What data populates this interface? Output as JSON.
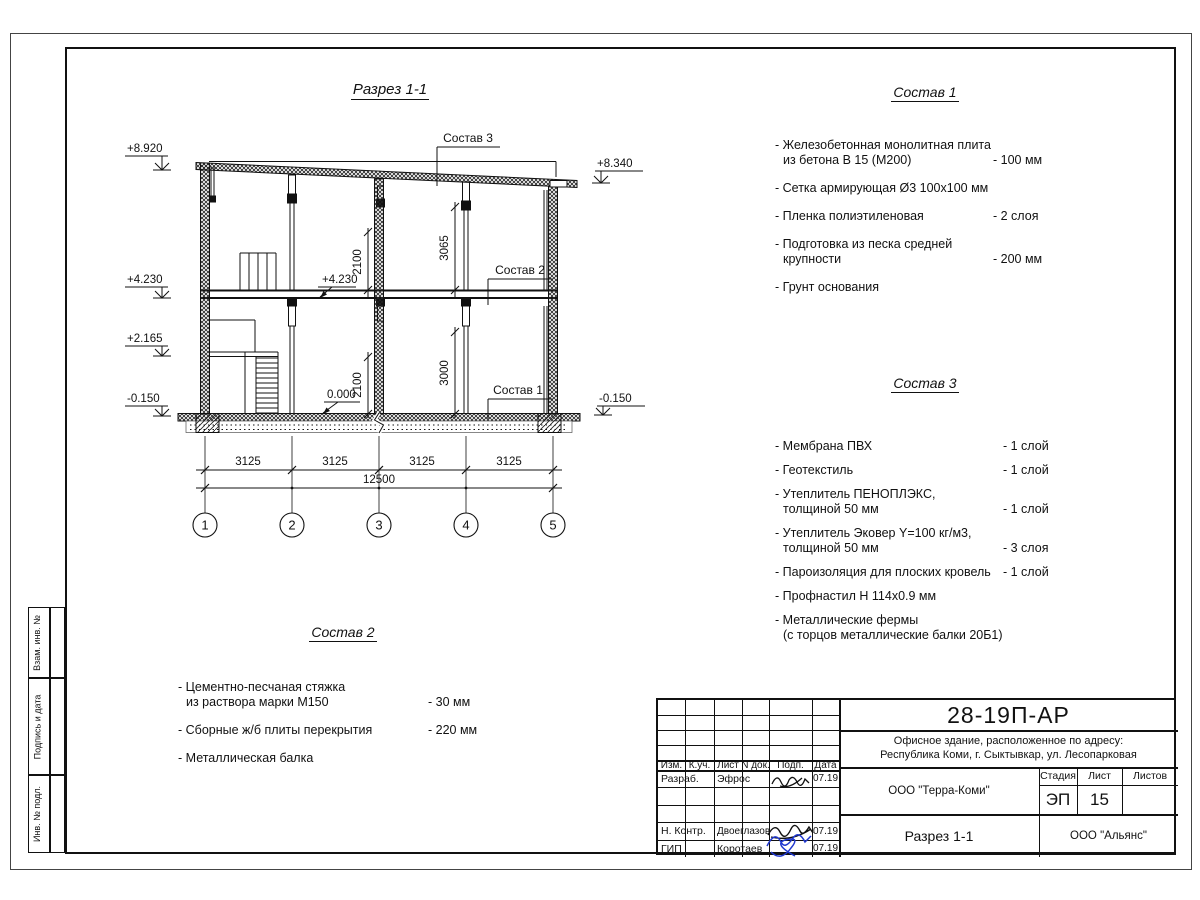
{
  "colors": {
    "line": "#111111",
    "signature_ink_blue": "#2038cf"
  },
  "drawing": {
    "title": "Разрез 1-1",
    "callouts": {
      "sostav1": "Состав 1",
      "sostav2": "Состав 2",
      "sostav3": "Состав 3"
    },
    "elevations": {
      "left_top": "+8.920",
      "left_mid": "+4.230",
      "left_low": "+2.165",
      "left_base": "-0.150",
      "right_top": "+8.340",
      "right_base": "-0.150",
      "inner_floor2": "+4.230",
      "inner_floor1": "0.000"
    },
    "vdims": {
      "floor2_opening": "2100",
      "floor2_clear": "3065",
      "floor1_opening": "2100",
      "floor1_clear": "3000"
    },
    "hdims": {
      "spans": [
        "3125",
        "3125",
        "3125",
        "3125"
      ],
      "total": "12500"
    },
    "axes": [
      "1",
      "2",
      "3",
      "4",
      "5"
    ]
  },
  "spec1": {
    "title": "Состав 1",
    "items": [
      {
        "line1": "- Железобетонная монолитная плита",
        "line2": "из бетона В 15 (М200)",
        "value": "- 100 мм"
      },
      {
        "line1": "- Сетка армирующая Ø3 100x100 мм",
        "line2": "",
        "value": ""
      },
      {
        "line1": "- Пленка полиэтиленовая",
        "line2": "",
        "value": "-  2 слоя"
      },
      {
        "line1": "- Подготовка из песка средней",
        "line2": "крупности",
        "value": "- 200 мм"
      },
      {
        "line1": "- Грунт основания",
        "line2": "",
        "value": ""
      }
    ]
  },
  "spec2": {
    "title": "Состав 2",
    "items": [
      {
        "line1": "- Цементно-песчаная стяжка",
        "line2": "из раствора марки М150",
        "value": "- 30 мм"
      },
      {
        "line1": "- Сборные ж/б плиты перекрытия",
        "line2": "",
        "value": "- 220 мм"
      },
      {
        "line1": "- Металлическая балка",
        "line2": "",
        "value": ""
      }
    ]
  },
  "spec3": {
    "title": "Состав 3",
    "items": [
      {
        "line1": "- Мембрана ПВХ",
        "line2": "",
        "value": "- 1 слой"
      },
      {
        "line1": "- Геотекстиль",
        "line2": "",
        "value": "- 1 слой"
      },
      {
        "line1": "- Утеплитель ПЕНОПЛЭКС,",
        "line2": "толщиной 50 мм",
        "value": "- 1 слой"
      },
      {
        "line1": "- Утеплитель Эковер Y=100 кг/м3,",
        "line2": "толщиной 50 мм",
        "value": "- 3 слоя"
      },
      {
        "line1": "- Пароизоляция для плоских кровель",
        "line2": "",
        "value": "- 1 слой"
      },
      {
        "line1": "- Профнастил Н 114x0.9 мм",
        "line2": "",
        "value": ""
      },
      {
        "line1": "- Металлические фермы",
        "line2": "(с торцов металлические балки 20Б1)",
        "value": ""
      }
    ]
  },
  "titleblock": {
    "code": "28-19П-АР",
    "object_line1": "Офисное здание, расположенное по адресу:",
    "object_line2": "Республика Коми, г. Сыктывкар, ул. Лесопарковая",
    "header": {
      "izm": "Изм.",
      "kuch": "К.уч.",
      "list": "Лист",
      "ndok": "N док.",
      "podp": "Подп.",
      "data": "Дата"
    },
    "rows": [
      {
        "role": "Разраб.",
        "name": "Эфрос",
        "date": "07.19"
      },
      {
        "role": "Н. Контр.",
        "name": "Двоеглазов",
        "date": "07.19"
      },
      {
        "role": "ГИП",
        "name": "Коротаев",
        "date": "07.19"
      }
    ],
    "company": "ООО \"Терра-Коми\"",
    "stage_label": "Стадия",
    "sheet_label": "Лист",
    "sheets_label": "Листов",
    "stage": "ЭП",
    "sheet_no": "15",
    "sheets_total": "",
    "doc_title": "Разрез 1-1",
    "contractor": "ООО \"Альянс\""
  },
  "side_labels": {
    "top": "Взам. инв. №",
    "mid": "Подпись и дата",
    "bottom": "Инв. № подл."
  }
}
